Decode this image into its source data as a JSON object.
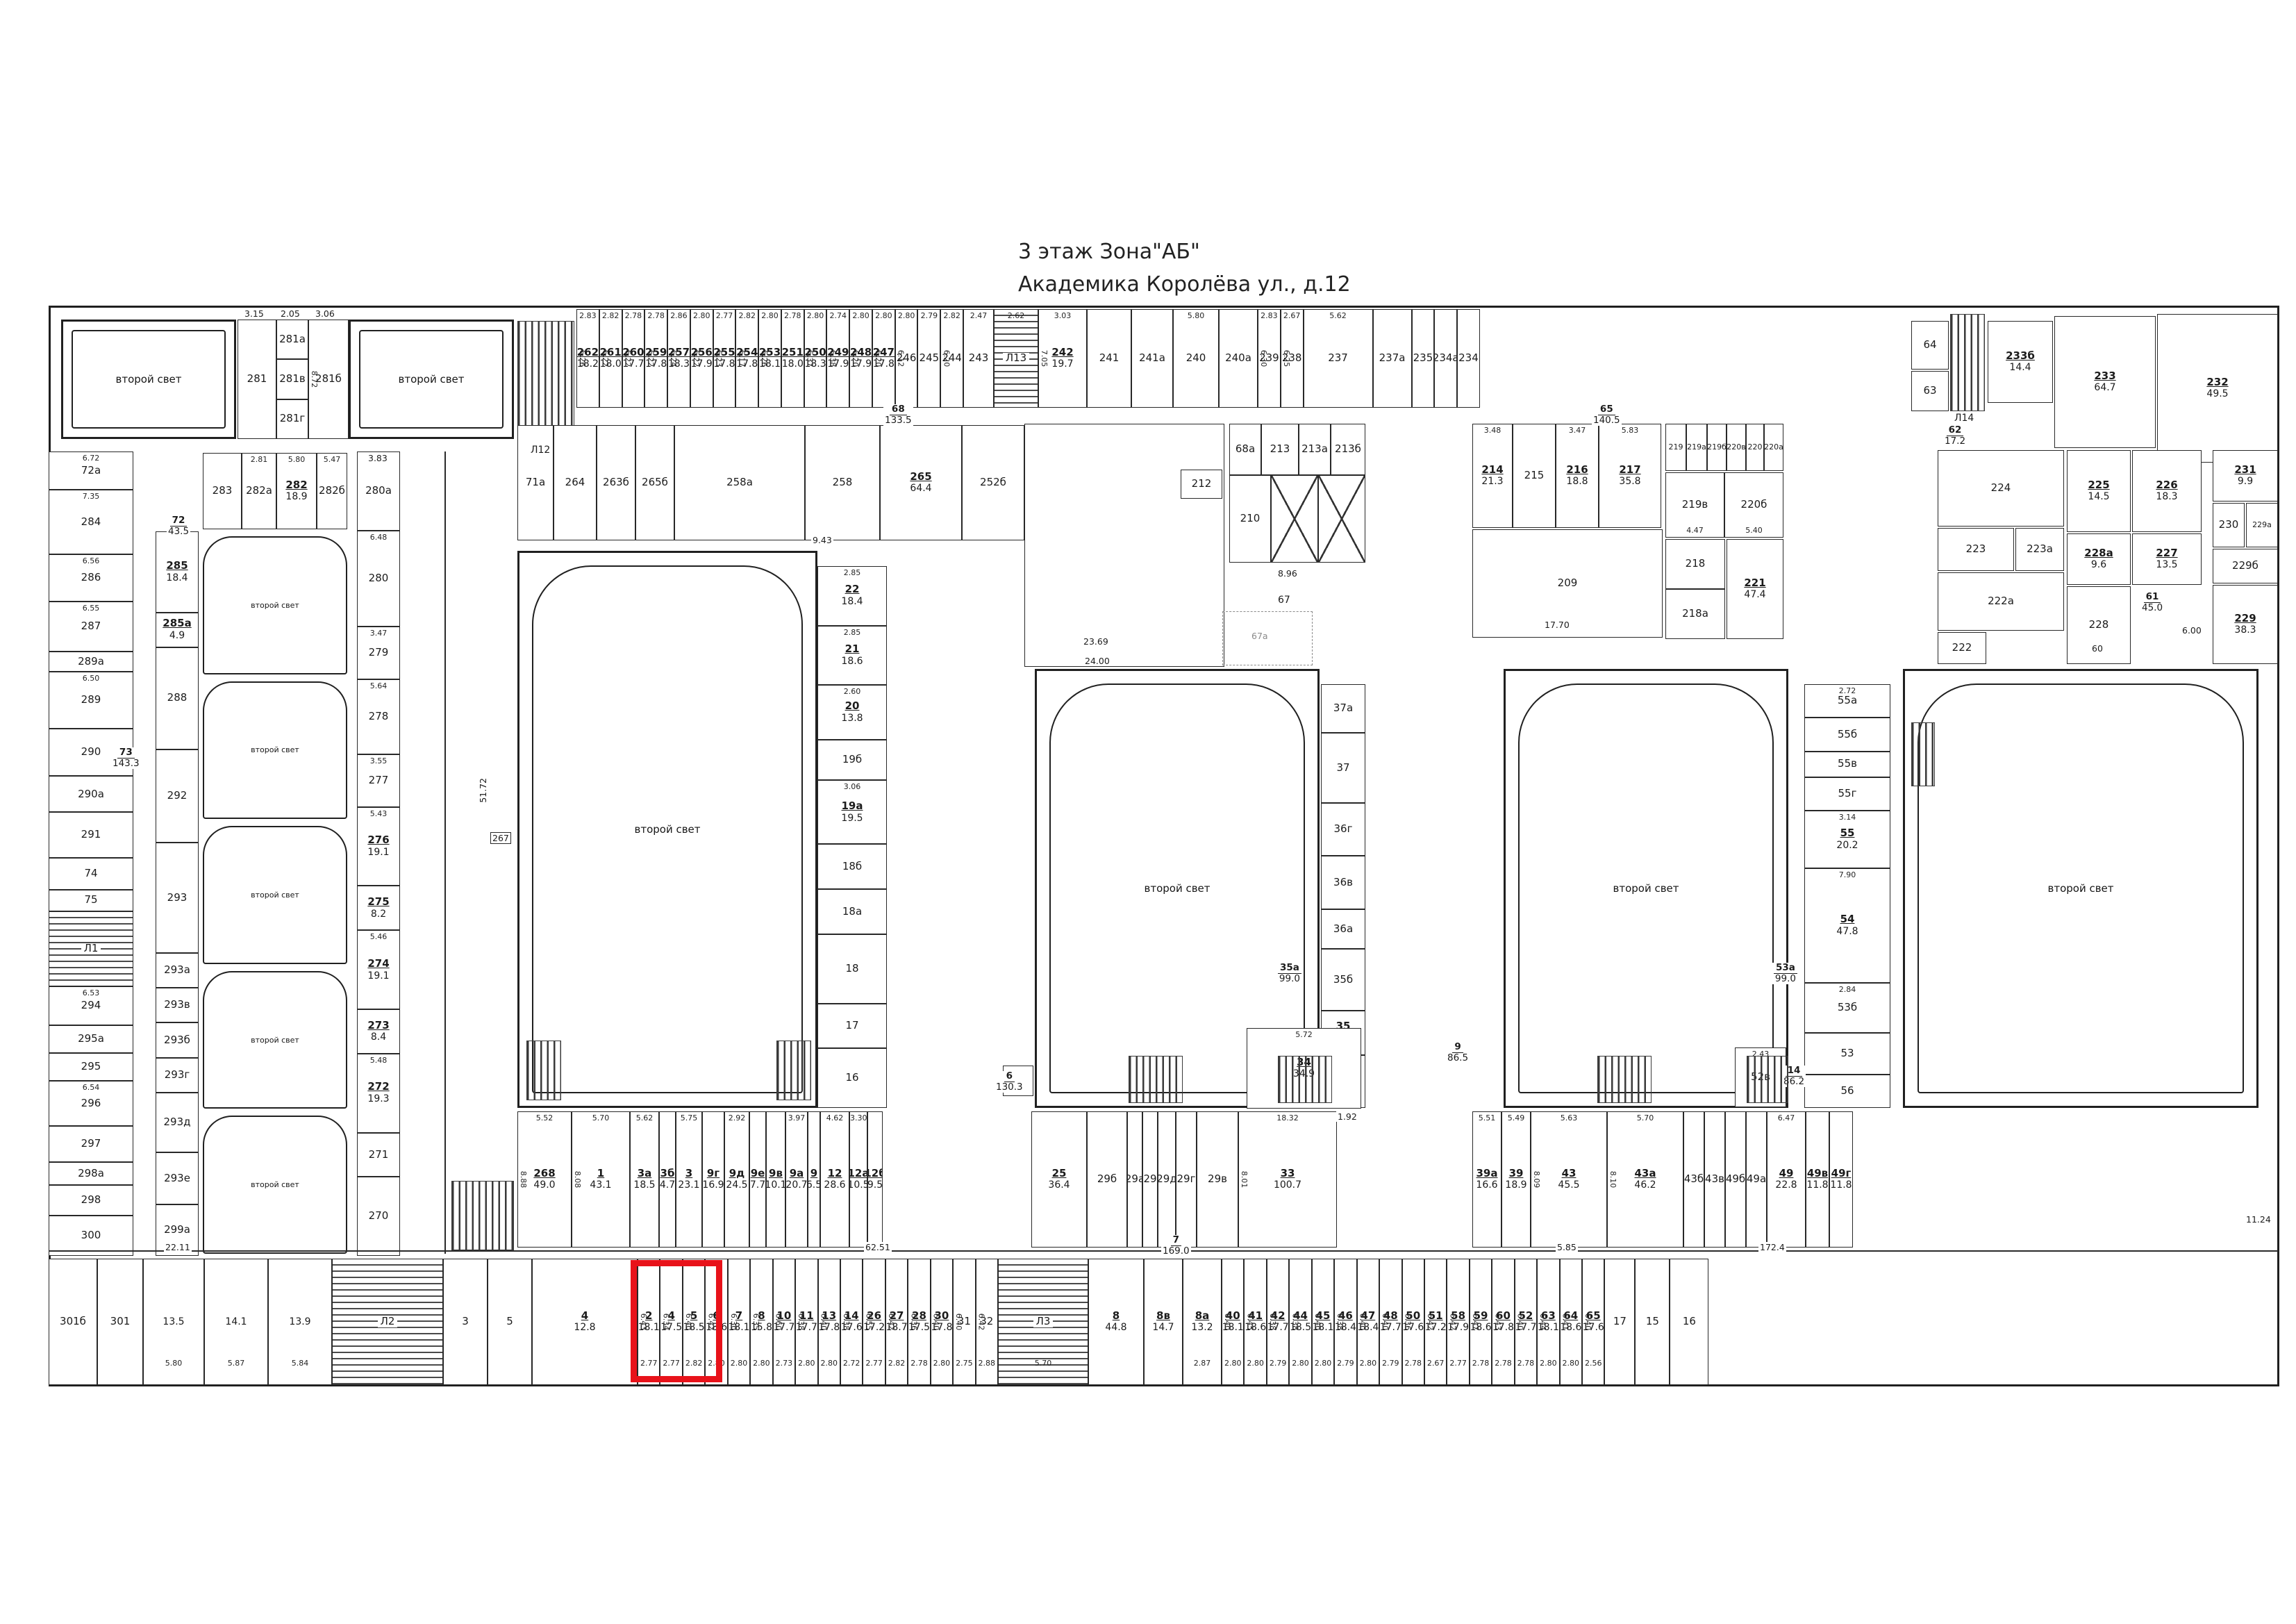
{
  "title": {
    "line1": "3 этаж    Зона\"АБ\"",
    "line2": "Академика Королёва ул., д.12"
  },
  "labels": {
    "second_light": "второй свет"
  },
  "corridors": {
    "c73": {
      "n": "73",
      "a": "143.3"
    },
    "c72": {
      "n": "72",
      "a": "43.5"
    },
    "c68": {
      "n": "68",
      "a": "133.5"
    },
    "c65": {
      "n": "65",
      "a": "140.5"
    },
    "c62": {
      "n": "62",
      "a": "17.2"
    },
    "c61": {
      "n": "61",
      "a": "45.0"
    },
    "c6": {
      "n": "6",
      "a": "130.3"
    },
    "c7": {
      "n": "7",
      "a": "169.0"
    },
    "c9": {
      "n": "9",
      "a": "86.5"
    },
    "c14": {
      "n": "14",
      "a": "86.2"
    },
    "c35a": {
      "n": "35а",
      "a": "99.0"
    },
    "c53a": {
      "n": "53а",
      "a": "99.0"
    }
  },
  "dims": {
    "d62_51": "62.51",
    "d172_4": "172.4",
    "d51_72": "51.72",
    "d23_69": "23.69",
    "d24_00": "24.00",
    "d17_70": "17.70",
    "d8_96": "8.96",
    "d9_43": "9.43",
    "d15_62": "15.62",
    "d60": "60",
    "d6_00": "6.00",
    "d11_24": "11.24",
    "d5_85": "5.85",
    "d3_83": "3.83",
    "d22_11": "22.11",
    "d5_72": "5.72",
    "d1_92": "1.92"
  },
  "misc": {
    "r267": "267",
    "r24": "24",
    "l12": "Л12",
    "l14": "Л14",
    "r34": {
      "n": "34",
      "a": "34.9",
      "w": "5.72"
    },
    "r52v": {
      "n": "52в",
      "w": "2.43"
    }
  },
  "top_left": {
    "r281": "281",
    "r281a": "281а",
    "r281v": "281в",
    "r281g": "281г",
    "r281b": "281б",
    "d315": "3.15",
    "d205": "2.05",
    "d306": "3.06",
    "d872": "8.72"
  },
  "row282": [
    {
      "n": "283",
      "fw": 56
    },
    {
      "n": "282а",
      "w": "2.81",
      "fw": 50
    },
    {
      "n": "282",
      "a": "18.9",
      "w": "5.80",
      "fw": 58
    },
    {
      "n": "282б",
      "w": "5.47",
      "fw": 44
    }
  ],
  "top_row": [
    {
      "n": "262",
      "a": "18.2",
      "w": "2.83",
      "h": "6.26"
    },
    {
      "n": "261",
      "a": "18.0",
      "w": "2.82",
      "h": "6.22"
    },
    {
      "n": "260",
      "a": "17.7",
      "w": "2.78",
      "h": "6.22"
    },
    {
      "n": "259",
      "a": "17.8",
      "w": "2.78",
      "h": "6.22"
    },
    {
      "n": "257",
      "a": "18.3",
      "w": "2.86",
      "h": "6.24"
    },
    {
      "n": "256",
      "a": "17.9",
      "w": "2.80",
      "h": "6.22"
    },
    {
      "n": "255",
      "a": "17.8",
      "w": "2.77",
      "h": "6.23"
    },
    {
      "n": "254",
      "a": "17.8",
      "w": "2.82",
      "h": "6.17"
    },
    {
      "n": "253",
      "a": "18.1",
      "w": "2.80",
      "h": "6.26"
    },
    {
      "n": "251",
      "a": "18.0",
      "w": "2.78"
    },
    {
      "n": "250",
      "a": "18.3",
      "w": "2.80",
      "h": "6.37"
    },
    {
      "n": "249",
      "a": "17.9",
      "w": "2.74",
      "h": "6.38"
    },
    {
      "n": "248",
      "a": "17.9",
      "w": "2.80",
      "h": "6.20"
    },
    {
      "n": "247",
      "a": "17.8",
      "w": "2.80",
      "h": "6.20"
    },
    {
      "n": "246",
      "w": "2.80",
      "h": "6.12"
    },
    {
      "n": "245",
      "w": "2.79"
    },
    {
      "n": "244",
      "w": "2.82",
      "h": "6.20"
    },
    {
      "n": "243",
      "w": "2.47",
      "fw": 44
    },
    {
      "n": "Л13",
      "cls": "stair",
      "w": "2.62",
      "fw": 64
    },
    {
      "n": "242",
      "a": "19.7",
      "w": "3.03",
      "h": "7.05",
      "fw": 70
    },
    {
      "n": "241",
      "fw": 64
    },
    {
      "n": "241а",
      "fw": 60
    },
    {
      "n": "240",
      "w": "5.80",
      "fw": 66
    },
    {
      "n": "240а",
      "fw": 56
    },
    {
      "n": "239",
      "w": "2.83",
      "h": "6.30"
    },
    {
      "n": "238",
      "w": "2.67",
      "h": "6.25"
    },
    {
      "n": "237",
      "w": "5.62",
      "fw": 100
    },
    {
      "n": "237а",
      "fw": 56
    },
    {
      "n": "235"
    },
    {
      "n": "234а"
    },
    {
      "n": "234"
    }
  ],
  "top_right": {
    "r64": "64",
    "r63": "63",
    "r233b": {
      "n": "233б",
      "a": "14.4"
    },
    "r233": {
      "n": "233",
      "a": "64.7"
    },
    "r232": {
      "n": "232",
      "a": "49.5"
    }
  },
  "row_above_hall1": [
    {
      "n": "71а",
      "fw": 52
    },
    {
      "n": "264",
      "fw": 62
    },
    {
      "n": "263б",
      "fw": 56
    },
    {
      "n": "265б",
      "fw": 56
    },
    {
      "n": "258а",
      "fw": 188
    },
    {
      "n": "258",
      "fw": 108
    },
    {
      "n": "265",
      "a": "64.4",
      "fw": 118
    },
    {
      "n": "252б",
      "fw": 90
    }
  ],
  "left_col": [
    {
      "n": "72а",
      "w": "6.72",
      "fh": 70
    },
    {
      "n": "284",
      "w": "7.35",
      "fh": 120
    },
    {
      "n": "286",
      "w": "6.56",
      "fh": 88
    },
    {
      "n": "287",
      "w": "6.55",
      "fh": 92
    },
    {
      "n": "289а",
      "fh": 36
    },
    {
      "n": "289",
      "w": "6.50",
      "fh": 105
    },
    {
      "n": "290",
      "fh": 88
    },
    {
      "n": "290а",
      "fh": 66
    },
    {
      "n": "291",
      "fh": 84
    },
    {
      "n": "74",
      "fh": 58
    },
    {
      "n": "75",
      "fh": 38
    },
    {
      "n": "Л1",
      "cls": "stair",
      "fh": 140
    },
    {
      "n": "294",
      "w": "6.53",
      "fh": 72
    },
    {
      "n": "295а",
      "fh": 50
    },
    {
      "n": "295",
      "fh": 50
    },
    {
      "n": "296",
      "w": "6.54",
      "fh": 84
    },
    {
      "n": "297",
      "fh": 66
    },
    {
      "n": "298а",
      "fh": 40
    },
    {
      "n": "298",
      "fh": 56
    },
    {
      "n": "300",
      "fh": 74
    }
  ],
  "inner_col": [
    {
      "n": "285",
      "a": "18.4",
      "fh": 95
    },
    {
      "n": "285а",
      "a": "4.9",
      "fh": 40
    },
    {
      "n": "288",
      "fh": 120
    },
    {
      "n": "292",
      "fh": 110
    },
    {
      "n": "293",
      "fh": 130
    },
    {
      "n": "293а",
      "fh": 40
    },
    {
      "n": "293в",
      "fh": 40
    },
    {
      "n": "293б",
      "fh": 40
    },
    {
      "n": "293г",
      "fh": 40
    },
    {
      "n": "293д",
      "fh": 70
    },
    {
      "n": "293е",
      "fh": 60
    },
    {
      "n": "299а",
      "fh": 60
    }
  ],
  "lr_col": [
    {
      "n": "280а",
      "w": "6.20",
      "fh": 90
    },
    {
      "n": "280",
      "w": "6.48",
      "fh": 110
    },
    {
      "n": "279",
      "w": "3.47",
      "fh": 60
    },
    {
      "n": "278",
      "w": "5.64",
      "fh": 85
    },
    {
      "n": "277",
      "w": "3.55",
      "fh": 60
    },
    {
      "n": "276",
      "a": "19.1",
      "w": "5.43",
      "fh": 90
    },
    {
      "n": "275",
      "a": "8.2",
      "fh": 50
    },
    {
      "n": "274",
      "a": "19.1",
      "w": "5.46",
      "fh": 90
    },
    {
      "n": "273",
      "a": "8.4",
      "fh": 50
    },
    {
      "n": "272",
      "a": "19.3",
      "w": "5.48",
      "fh": 90
    },
    {
      "n": "271",
      "fh": 50
    },
    {
      "n": "270",
      "fh": 90
    }
  ],
  "hall1_col": [
    {
      "n": "22",
      "a": "18.4",
      "w": "2.85",
      "fh": 60
    },
    {
      "n": "21",
      "a": "18.6",
      "w": "2.85",
      "fh": 60
    },
    {
      "n": "20",
      "a": "13.8",
      "w": "2.60",
      "fh": 55
    },
    {
      "n": "19б",
      "fh": 40
    },
    {
      "n": "19а",
      "a": "19.5",
      "w": "3.06",
      "fh": 65
    },
    {
      "n": "18б",
      "fh": 45
    },
    {
      "n": "18а",
      "fh": 45
    },
    {
      "n": "18",
      "fh": 70
    },
    {
      "n": "17",
      "fh": 45
    },
    {
      "n": "16",
      "fh": 60
    }
  ],
  "hall2_col": [
    {
      "n": "37а",
      "w": "2.69",
      "fh": 55
    },
    {
      "n": "37",
      "w": "3.09",
      "fh": 80
    },
    {
      "n": "36г",
      "fh": 60
    },
    {
      "n": "36в",
      "fh": 60
    },
    {
      "n": "36а",
      "fh": 45
    },
    {
      "n": "35б",
      "w": "2.83",
      "fh": 70
    },
    {
      "n": "35",
      "a": "8.7",
      "fh": 50
    },
    {
      "n": "34б",
      "fh": 60
    }
  ],
  "hall34_col": [
    {
      "n": "55а",
      "w": "2.72",
      "fh": 40
    },
    {
      "n": "55б",
      "fh": 40
    },
    {
      "n": "55в",
      "fh": 30
    },
    {
      "n": "55г",
      "fh": 40
    },
    {
      "n": "55",
      "a": "20.2",
      "w": "3.14",
      "fh": 70
    },
    {
      "n": "54",
      "a": "47.8",
      "w": "7.90",
      "fh": 140
    },
    {
      "n": "53б",
      "w": "2.84",
      "fh": 60
    },
    {
      "n": "53",
      "fh": 50
    },
    {
      "n": "56",
      "fh": 40
    }
  ],
  "center": {
    "r212": "212",
    "r68a": "68а",
    "r210": "210",
    "r67": "67",
    "r67a": "67а",
    "core1": [
      {
        "n": "68а",
        "fw": 46
      },
      {
        "n": "213",
        "fw": 54
      },
      {
        "n": "213а",
        "fw": 46
      },
      {
        "n": "213б",
        "fw": 50
      }
    ],
    "core2": [
      {
        "n": "210",
        "fw": 60
      },
      {
        "cls": "lift",
        "fw": 68
      },
      {
        "cls": "lift",
        "fw": 68
      }
    ],
    "block215": [
      {
        "n": "214",
        "a": "21.3",
        "w": "3.48",
        "fw": 58
      },
      {
        "n": "215",
        "fw": 62
      },
      {
        "n": "216",
        "a": "18.8",
        "w": "3.47",
        "fw": 62
      },
      {
        "n": "217",
        "a": "35.8",
        "w": "5.83",
        "fw": 90
      }
    ],
    "r219row": [
      {
        "n": "219",
        "fw": 30
      },
      {
        "n": "219а",
        "fw": 30
      },
      {
        "n": "219б",
        "fw": 28
      },
      {
        "n": "220в",
        "fw": 28
      },
      {
        "n": "220",
        "fw": 26
      },
      {
        "n": "220а",
        "fw": 28
      }
    ],
    "r219brow": [
      {
        "n": "219в",
        "w": "4.47",
        "fw": 85
      },
      {
        "n": "220б",
        "w": "5.40",
        "fw": 85
      }
    ],
    "r218col": [
      {
        "n": "218",
        "fh": 1
      },
      {
        "n": "218а",
        "fh": 1
      }
    ],
    "r209": {
      "n": "209"
    },
    "r221": {
      "n": "221",
      "a": "47.4",
      "w": "5.70"
    }
  },
  "right_block": {
    "r224": {
      "n": "224"
    },
    "r223": {
      "n": "223",
      "w": "3.35"
    },
    "r223a": {
      "n": "223а"
    },
    "r222a": {
      "n": "222а"
    },
    "r222": {
      "n": "222"
    },
    "r225": {
      "n": "225",
      "a": "14.5",
      "w": "2.84"
    },
    "r226": {
      "n": "226",
      "a": "18.3",
      "w": "3.50"
    },
    "r228a": {
      "n": "228а",
      "a": "9.6"
    },
    "r227": {
      "n": "227",
      "a": "13.5"
    },
    "r228": {
      "n": "228"
    },
    "r231": {
      "n": "231",
      "a": "9.9"
    },
    "r230": {
      "n": "230"
    },
    "r229a": {
      "n": "229а"
    },
    "r229b": {
      "n": "229б"
    },
    "r229": {
      "n": "229",
      "a": "38.3"
    }
  },
  "mid_left_band": [
    {
      "n": "268",
      "a": "49.0",
      "w": "5.52",
      "h": "8.88",
      "fw": 78
    },
    {
      "n": "1",
      "a": "43.1",
      "w": "5.70",
      "h": "8.08",
      "fw": 84
    },
    {
      "n": "3а",
      "a": "18.5",
      "w": "5.62",
      "fw": 42
    },
    {
      "n": "3б",
      "a": "4.7",
      "fw": 24
    },
    {
      "n": "3",
      "a": "23.1",
      "w": "5.75",
      "fw": 38
    },
    {
      "n": "9г",
      "a": "16.9",
      "fw": 32
    },
    {
      "n": "9д",
      "a": "24.5",
      "w": "2.92",
      "fw": 36
    },
    {
      "n": "9е",
      "a": "7.7",
      "fw": 24
    },
    {
      "n": "9в",
      "a": "10.1",
      "fw": 28
    },
    {
      "n": "9а",
      "a": "20.7",
      "w": "3.97",
      "fw": 32
    },
    {
      "n": "9",
      "a": "6.5",
      "fw": 18
    },
    {
      "n": "12",
      "a": "28.6",
      "w": "4.62",
      "fw": 42
    },
    {
      "n": "12а",
      "a": "10.5",
      "w": "3.30",
      "fw": 26
    },
    {
      "n": "12б",
      "a": "9.5",
      "fw": 22
    }
  ],
  "mid_right_a": [
    {
      "n": "25",
      "a": "36.4",
      "fw": 80
    },
    {
      "n": "29б",
      "fw": 58
    },
    {
      "n": "29а",
      "fw": 22
    },
    {
      "n": "29",
      "fw": 22
    },
    {
      "n": "29д",
      "fw": 26
    },
    {
      "n": "29г",
      "fw": 30
    },
    {
      "n": "29в",
      "fw": 60
    },
    {
      "n": "33",
      "a": "100.7",
      "w": "18.32",
      "h": "8.01",
      "fw": 142
    }
  ],
  "mid_right_b": [
    {
      "n": "39а",
      "a": "16.6",
      "w": "5.51",
      "fw": 42
    },
    {
      "n": "39",
      "a": "18.9",
      "w": "5.49",
      "fw": 42
    },
    {
      "n": "43",
      "a": "45.5",
      "w": "5.63",
      "h": "8.09",
      "fw": 110
    },
    {
      "n": "43а",
      "a": "46.2",
      "w": "5.70",
      "h": "8.10",
      "fw": 110
    },
    {
      "n": "43б",
      "fw": 30
    },
    {
      "n": "43в",
      "fw": 30
    },
    {
      "n": "49б",
      "fw": 30
    },
    {
      "n": "49а",
      "fw": 30
    },
    {
      "n": "49",
      "a": "22.8",
      "w": "6.47",
      "fw": 56
    },
    {
      "n": "49в",
      "a": "11.8",
      "fw": 34
    },
    {
      "n": "49г",
      "a": "11.8",
      "fw": 34
    }
  ],
  "bottom_left": [
    {
      "n": "301б",
      "fw": 70
    },
    {
      "n": "301",
      "fw": 66
    },
    {
      "a": "13.5",
      "w": "5.80",
      "fw": 88
    },
    {
      "a": "14.1",
      "w": "5.87",
      "fw": 92
    },
    {
      "a": "13.9",
      "w": "5.84",
      "fw": 92
    },
    {
      "n": "Л2",
      "cls": "stair",
      "fw": 160
    },
    {
      "n": "3",
      "fw": 64
    },
    {
      "n": "5",
      "fw": 64
    },
    {
      "n": "4",
      "a": "12.8",
      "fw": 152
    }
  ],
  "bottom_band": [
    {
      "n": "2",
      "a": "18.1",
      "w": "2.77",
      "h": "6.43",
      "hl": 1
    },
    {
      "n": "4",
      "a": "17.5",
      "w": "2.77",
      "h": "6.34",
      "hl": 1
    },
    {
      "n": "5",
      "a": "18.5",
      "w": "2.82",
      "h": "6.40"
    },
    {
      "n": "6",
      "a": "18.6",
      "w": "2.80",
      "h": "6.42"
    },
    {
      "n": "7",
      "a": "18.1",
      "w": "2.80",
      "h": "6.30"
    },
    {
      "n": "8",
      "a": "15.8",
      "w": "2.80",
      "h": "6.35"
    },
    {
      "n": "10",
      "a": "17.7",
      "w": "2.73",
      "h": "6.60"
    },
    {
      "n": "11",
      "a": "17.7",
      "w": "2.80",
      "h": "6.38"
    },
    {
      "n": "13",
      "a": "17.8",
      "w": "2.80",
      "h": "6.40"
    },
    {
      "n": "14",
      "a": "17.6",
      "w": "2.72",
      "h": "6.38"
    },
    {
      "n": "26",
      "a": "17.2",
      "w": "2.77",
      "h": "6.55"
    },
    {
      "n": "27",
      "a": "18.7",
      "w": "2.82",
      "h": "6.42"
    },
    {
      "n": "28",
      "a": "17.5",
      "w": "2.78",
      "h": "6.36"
    },
    {
      "n": "30",
      "a": "17.8",
      "w": "2.80",
      "h": "6.40"
    },
    {
      "n": "31",
      "w": "2.75",
      "h": "6.40"
    },
    {
      "n": "32",
      "w": "2.88",
      "h": "6.42"
    },
    {
      "n": "Л3",
      "cls": "stair",
      "w": "5.70",
      "fw": 130
    },
    {
      "n": "8",
      "a": "44.8",
      "fw": 80
    },
    {
      "n": "8в",
      "a": "14.7",
      "fw": 56
    },
    {
      "n": "8а",
      "a": "13.2",
      "w": "2.87",
      "fw": 56
    },
    {
      "n": "40",
      "a": "18.1",
      "w": "2.80",
      "h": "6.40"
    },
    {
      "n": "41",
      "a": "18.6",
      "w": "2.80",
      "h": "6.45"
    },
    {
      "n": "42",
      "a": "17.7",
      "w": "2.79",
      "h": "6.38"
    },
    {
      "n": "44",
      "a": "18.5",
      "w": "2.80",
      "h": "6.38"
    },
    {
      "n": "45",
      "a": "18.1",
      "w": "2.80",
      "h": "6.40"
    },
    {
      "n": "46",
      "a": "18.4",
      "w": "2.79",
      "h": "6.38"
    },
    {
      "n": "47",
      "a": "18.4",
      "w": "2.80",
      "h": "6.40"
    },
    {
      "n": "48",
      "a": "17.7",
      "w": "2.79",
      "h": "6.40"
    },
    {
      "n": "50",
      "a": "17.6",
      "w": "2.78",
      "h": "6.36"
    },
    {
      "n": "51",
      "a": "17.2",
      "w": "2.67",
      "h": "6.42"
    },
    {
      "n": "58",
      "a": "17.9",
      "w": "2.77",
      "h": "6.42"
    },
    {
      "n": "59",
      "a": "18.6",
      "w": "2.78",
      "h": "6.47"
    },
    {
      "n": "60",
      "a": "17.8",
      "w": "2.78",
      "h": "6.43"
    },
    {
      "n": "52",
      "a": "17.7",
      "w": "2.78",
      "h": "6.40"
    },
    {
      "n": "63",
      "a": "18.1",
      "w": "2.80",
      "h": "6.44"
    },
    {
      "n": "64",
      "a": "18.6",
      "w": "2.80",
      "h": "6.41"
    },
    {
      "n": "65",
      "a": "17.6",
      "w": "2.56",
      "h": "6.40"
    },
    {
      "n": "17",
      "fw": 44
    },
    {
      "n": "15",
      "fw": 50
    },
    {
      "n": "16",
      "fw": 56
    }
  ],
  "highlight": {
    "rooms": "2, 4",
    "color": "#e8121a"
  }
}
